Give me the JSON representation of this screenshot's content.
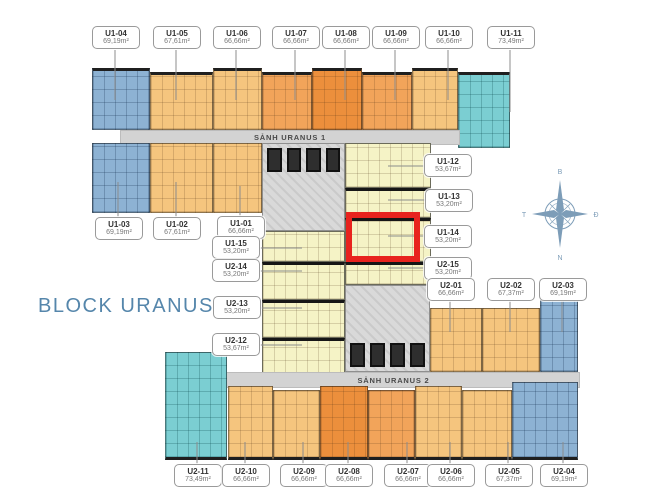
{
  "title": "BLOCK URANUS",
  "corridors": [
    {
      "label": "SẢNH URANUS 1"
    },
    {
      "label": "SẢNH URANUS 2"
    }
  ],
  "compass": {
    "b": "B",
    "d": "Đ",
    "n": "N",
    "t": "T"
  },
  "highlight": {
    "unit": "U1-14"
  },
  "colors": {
    "blue": "#8db2d3",
    "tan": "#f5c57e",
    "orange": "#f2a45a",
    "orangeDark": "#ec8f3c",
    "teal": "#7bced2",
    "yellow": "#f5f3c6",
    "core": "#d9d9d9",
    "corridor": "#d3d3d3",
    "highlight": "#e8231e",
    "accent": "#5586ab",
    "badgeBorder": "#9a9a9a",
    "line": "#8c8c8c",
    "compass": "#7d9db8"
  },
  "units": {
    "u104": {
      "id": "U1-04",
      "area": "69,19m²"
    },
    "u105": {
      "id": "U1-05",
      "area": "67,61m²"
    },
    "u106": {
      "id": "U1-06",
      "area": "66,66m²"
    },
    "u107": {
      "id": "U1-07",
      "area": "66,66m²"
    },
    "u108": {
      "id": "U1-08",
      "area": "66,66m²"
    },
    "u109": {
      "id": "U1-09",
      "area": "66,66m²"
    },
    "u110": {
      "id": "U1-10",
      "area": "66,66m²"
    },
    "u111": {
      "id": "U1-11",
      "area": "73,49m²"
    },
    "u103": {
      "id": "U1-03",
      "area": "69,19m²"
    },
    "u102": {
      "id": "U1-02",
      "area": "67,61m²"
    },
    "u101": {
      "id": "U1-01",
      "area": "66,66m²"
    },
    "u115": {
      "id": "U1-15",
      "area": "53,20m²"
    },
    "u214": {
      "id": "U2-14",
      "area": "53,20m²"
    },
    "u213": {
      "id": "U2-13",
      "area": "53,20m²"
    },
    "u212": {
      "id": "U2-12",
      "area": "53,67m²"
    },
    "u112": {
      "id": "U1-12",
      "area": "53,67m²"
    },
    "u113": {
      "id": "U1-13",
      "area": "53,20m²"
    },
    "u114": {
      "id": "U1-14",
      "area": "53,20m²"
    },
    "u215": {
      "id": "U2-15",
      "area": "53,20m²"
    },
    "u201": {
      "id": "U2-01",
      "area": "66,66m²"
    },
    "u202": {
      "id": "U2-02",
      "area": "67,37m²"
    },
    "u203": {
      "id": "U2-03",
      "area": "69,19m²"
    },
    "u211": {
      "id": "U2-11",
      "area": "73,49m²"
    },
    "u210": {
      "id": "U2-10",
      "area": "66,66m²"
    },
    "u209": {
      "id": "U2-09",
      "area": "66,66m²"
    },
    "u208": {
      "id": "U2-08",
      "area": "66,66m²"
    },
    "u207": {
      "id": "U2-07",
      "area": "66,66m²"
    },
    "u206": {
      "id": "U2-06",
      "area": "66,66m²"
    },
    "u205": {
      "id": "U2-05",
      "area": "67,37m²"
    },
    "u204": {
      "id": "U2-04",
      "area": "69,19m²"
    }
  }
}
